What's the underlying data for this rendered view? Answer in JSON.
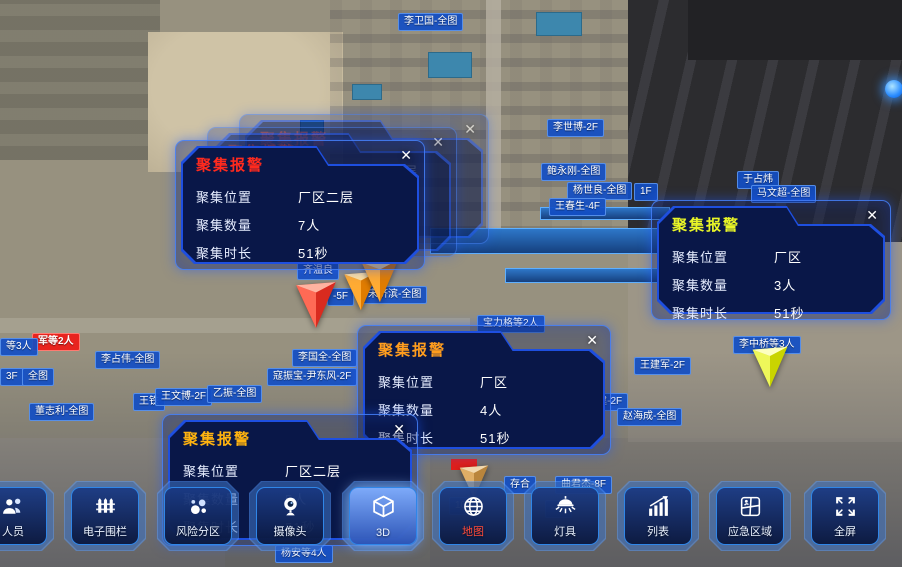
{
  "alerts": {
    "close_glyph": "✕",
    "field_labels": {
      "location": "聚集位置",
      "count": "聚集数量",
      "duration": "聚集时长"
    },
    "popups": [
      {
        "key": "front-left",
        "title": "聚集报警",
        "title_color": "#ff2a1e",
        "location": "厂区二层",
        "count": "7人",
        "duration": "51秒"
      },
      {
        "key": "right",
        "title": "聚集报警",
        "title_color": "#e8f527",
        "location": "厂区",
        "count": "3人",
        "duration": "51秒"
      },
      {
        "key": "middle",
        "title": "聚集报警",
        "title_color": "#ff9d1e",
        "location": "厂区",
        "count": "4人",
        "duration": "51秒"
      },
      {
        "key": "bottom",
        "title": "聚集报警",
        "title_color": "#ffb30f",
        "location": "厂区二层",
        "count": "5人",
        "duration": "51秒"
      },
      {
        "key": "ghost",
        "title": "聚集报警",
        "title_color": "#b3241e",
        "location": "厂区二层",
        "count": "5人",
        "duration": "51秒"
      }
    ]
  },
  "toolbar": {
    "items": [
      {
        "label": "人员",
        "icon": "people-icon"
      },
      {
        "label": "电子围栏",
        "icon": "fence-icon"
      },
      {
        "label": "风险分区",
        "icon": "risk-zones-icon"
      },
      {
        "label": "摄像头",
        "icon": "camera-icon"
      },
      {
        "label": "3D",
        "icon": "cube-3d-icon"
      },
      {
        "label": "地图",
        "icon": "globe-icon",
        "label_color": "#ff4a3a"
      },
      {
        "label": "灯具",
        "icon": "lamp-icon"
      },
      {
        "label": "列表",
        "icon": "list-chart-icon"
      },
      {
        "label": "应急区域",
        "icon": "emergency-area-icon"
      },
      {
        "label": "全屏",
        "icon": "fullscreen-icon"
      }
    ]
  },
  "map_labels": [
    {
      "text": "李卫国-全图",
      "x": 398,
      "y": 13
    },
    {
      "text": "李世博-2F",
      "x": 547,
      "y": 119
    },
    {
      "text": "鲍永刚-全图",
      "x": 541,
      "y": 163
    },
    {
      "text": "杨世良-全图",
      "x": 567,
      "y": 182
    },
    {
      "text": "1F",
      "x": 634,
      "y": 183
    },
    {
      "text": "王春生-4F",
      "x": 549,
      "y": 198
    },
    {
      "text": "于占炜",
      "x": 737,
      "y": 171
    },
    {
      "text": "马文超-全图",
      "x": 751,
      "y": 185
    },
    {
      "text": "齐温良",
      "x": 297,
      "y": 262
    },
    {
      "text": "-5F",
      "x": 327,
      "y": 288
    },
    {
      "text": "宋济滨-全图",
      "x": 362,
      "y": 286
    },
    {
      "text": "宝力格等2人",
      "x": 477,
      "y": 315
    },
    {
      "text": "王建军-2F",
      "x": 634,
      "y": 357
    },
    {
      "text": "李中桥等3人",
      "x": 733,
      "y": 336
    },
    {
      "text": "军等2人",
      "x": 32,
      "y": 333,
      "variant": "red"
    },
    {
      "text": "等3人",
      "x": 0,
      "y": 338
    },
    {
      "text": "李占伟-全图",
      "x": 95,
      "y": 351
    },
    {
      "text": "3F",
      "x": 0,
      "y": 368
    },
    {
      "text": "全图",
      "x": 22,
      "y": 368
    },
    {
      "text": "王铁",
      "x": 133,
      "y": 393
    },
    {
      "text": "王文博-2F",
      "x": 155,
      "y": 388
    },
    {
      "text": "乙振-全图",
      "x": 207,
      "y": 385
    },
    {
      "text": "寇振宝-尹东风-2F",
      "x": 267,
      "y": 368
    },
    {
      "text": "李国全-全图",
      "x": 292,
      "y": 349
    },
    {
      "text": "董志利-全图",
      "x": 29,
      "y": 403
    },
    {
      "text": "王云财-全图",
      "x": 499,
      "y": 368
    },
    {
      "text": "杨久森-全图 宋子建-2F",
      "x": 515,
      "y": 393
    },
    {
      "text": "赵海成-全图",
      "x": 617,
      "y": 408
    },
    {
      "text": "存合",
      "x": 504,
      "y": 476
    },
    {
      "text": "曲君杰-8F",
      "x": 555,
      "y": 476
    },
    {
      "text": "10F",
      "x": 449,
      "y": 497
    },
    {
      "text": "-4F",
      "x": 545,
      "y": 500
    },
    {
      "text": "杨安等4人",
      "x": 275,
      "y": 545
    }
  ],
  "markers": [
    {
      "name": "red-alarm",
      "x": 291,
      "y": 280,
      "size": 50,
      "fills": [
        "#ffb3a0",
        "#ff6a55",
        "#d92b1f"
      ]
    },
    {
      "name": "orange-alarm",
      "x": 340,
      "y": 270,
      "size": 42,
      "fills": [
        "#ffdf9e",
        "#ffab33",
        "#e07c00"
      ]
    },
    {
      "name": "orange-alarm",
      "x": 357,
      "y": 258,
      "size": 46,
      "fills": [
        "#ffdf9e",
        "#ffab33",
        "#e07c00"
      ]
    },
    {
      "name": "yellow-alarm",
      "x": 748,
      "y": 345,
      "size": 44,
      "fills": [
        "#fdffc0",
        "#eef75a",
        "#c9d400"
      ]
    },
    {
      "name": "tan-alarm",
      "x": 456,
      "y": 464,
      "size": 36,
      "fills": [
        "#f2d9ae",
        "#dfae66",
        "#b9853c"
      ]
    }
  ],
  "colors": {
    "popup_border": "#2b6bff",
    "tag_blue": "#124ec4",
    "tag_red": "#e8241f"
  }
}
